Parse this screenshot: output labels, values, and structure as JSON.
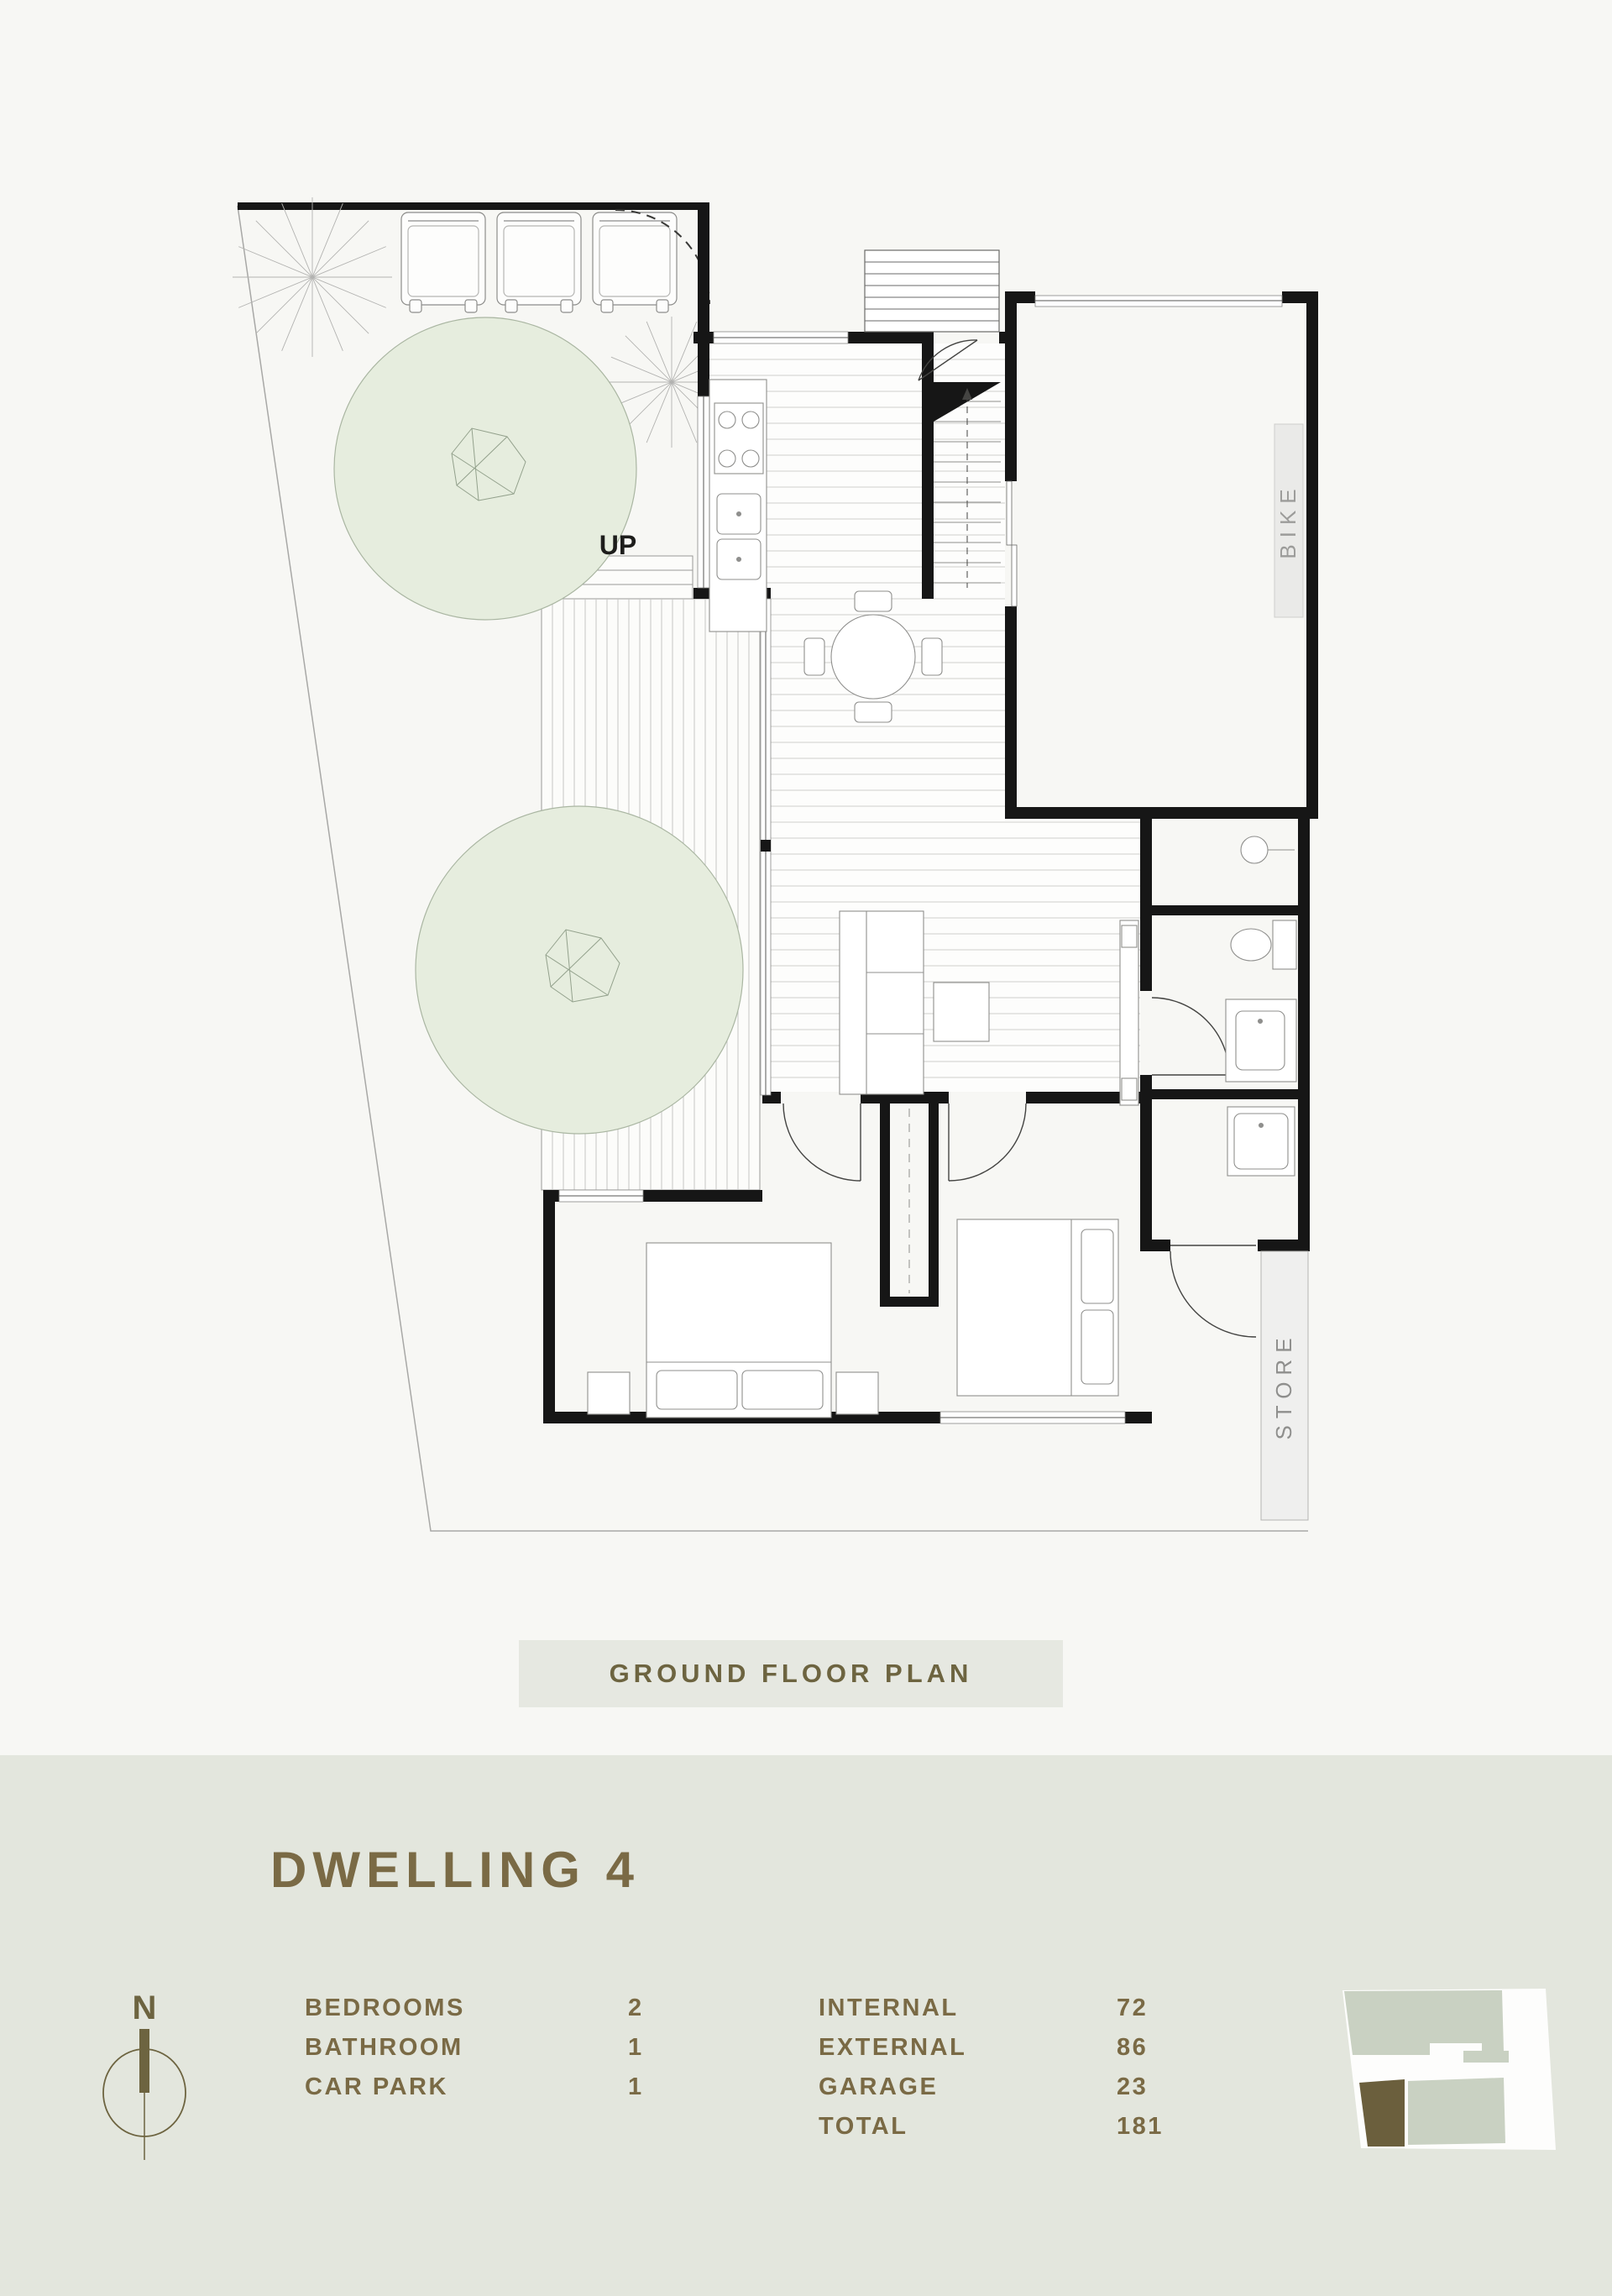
{
  "page": {
    "background": "#f7f7f4",
    "panel_background": "#e3e6dd",
    "accent_text_color": "#7a6a45",
    "caption_background": "#e6e8e1",
    "wall_color": "#161616",
    "tree_fill": "#e6edde",
    "keyplan_sage": "#c9d1c2",
    "keyplan_highlight": "#6b5f3d"
  },
  "plan": {
    "caption": "GROUND FLOOR PLAN",
    "labels": {
      "up": "UP",
      "bike": "BIKE",
      "store": "STORE"
    }
  },
  "details": {
    "title": "DWELLING 4",
    "compass_label": "N",
    "stats_left": [
      {
        "label": "BEDROOMS",
        "value": "2"
      },
      {
        "label": "BATHROOM",
        "value": "1"
      },
      {
        "label": "CAR PARK",
        "value": "1"
      }
    ],
    "stats_right": [
      {
        "label": "INTERNAL",
        "value": "72"
      },
      {
        "label": "EXTERNAL",
        "value": "86"
      },
      {
        "label": "GARAGE",
        "value": "23"
      },
      {
        "label": "TOTAL",
        "value": "181"
      }
    ]
  }
}
